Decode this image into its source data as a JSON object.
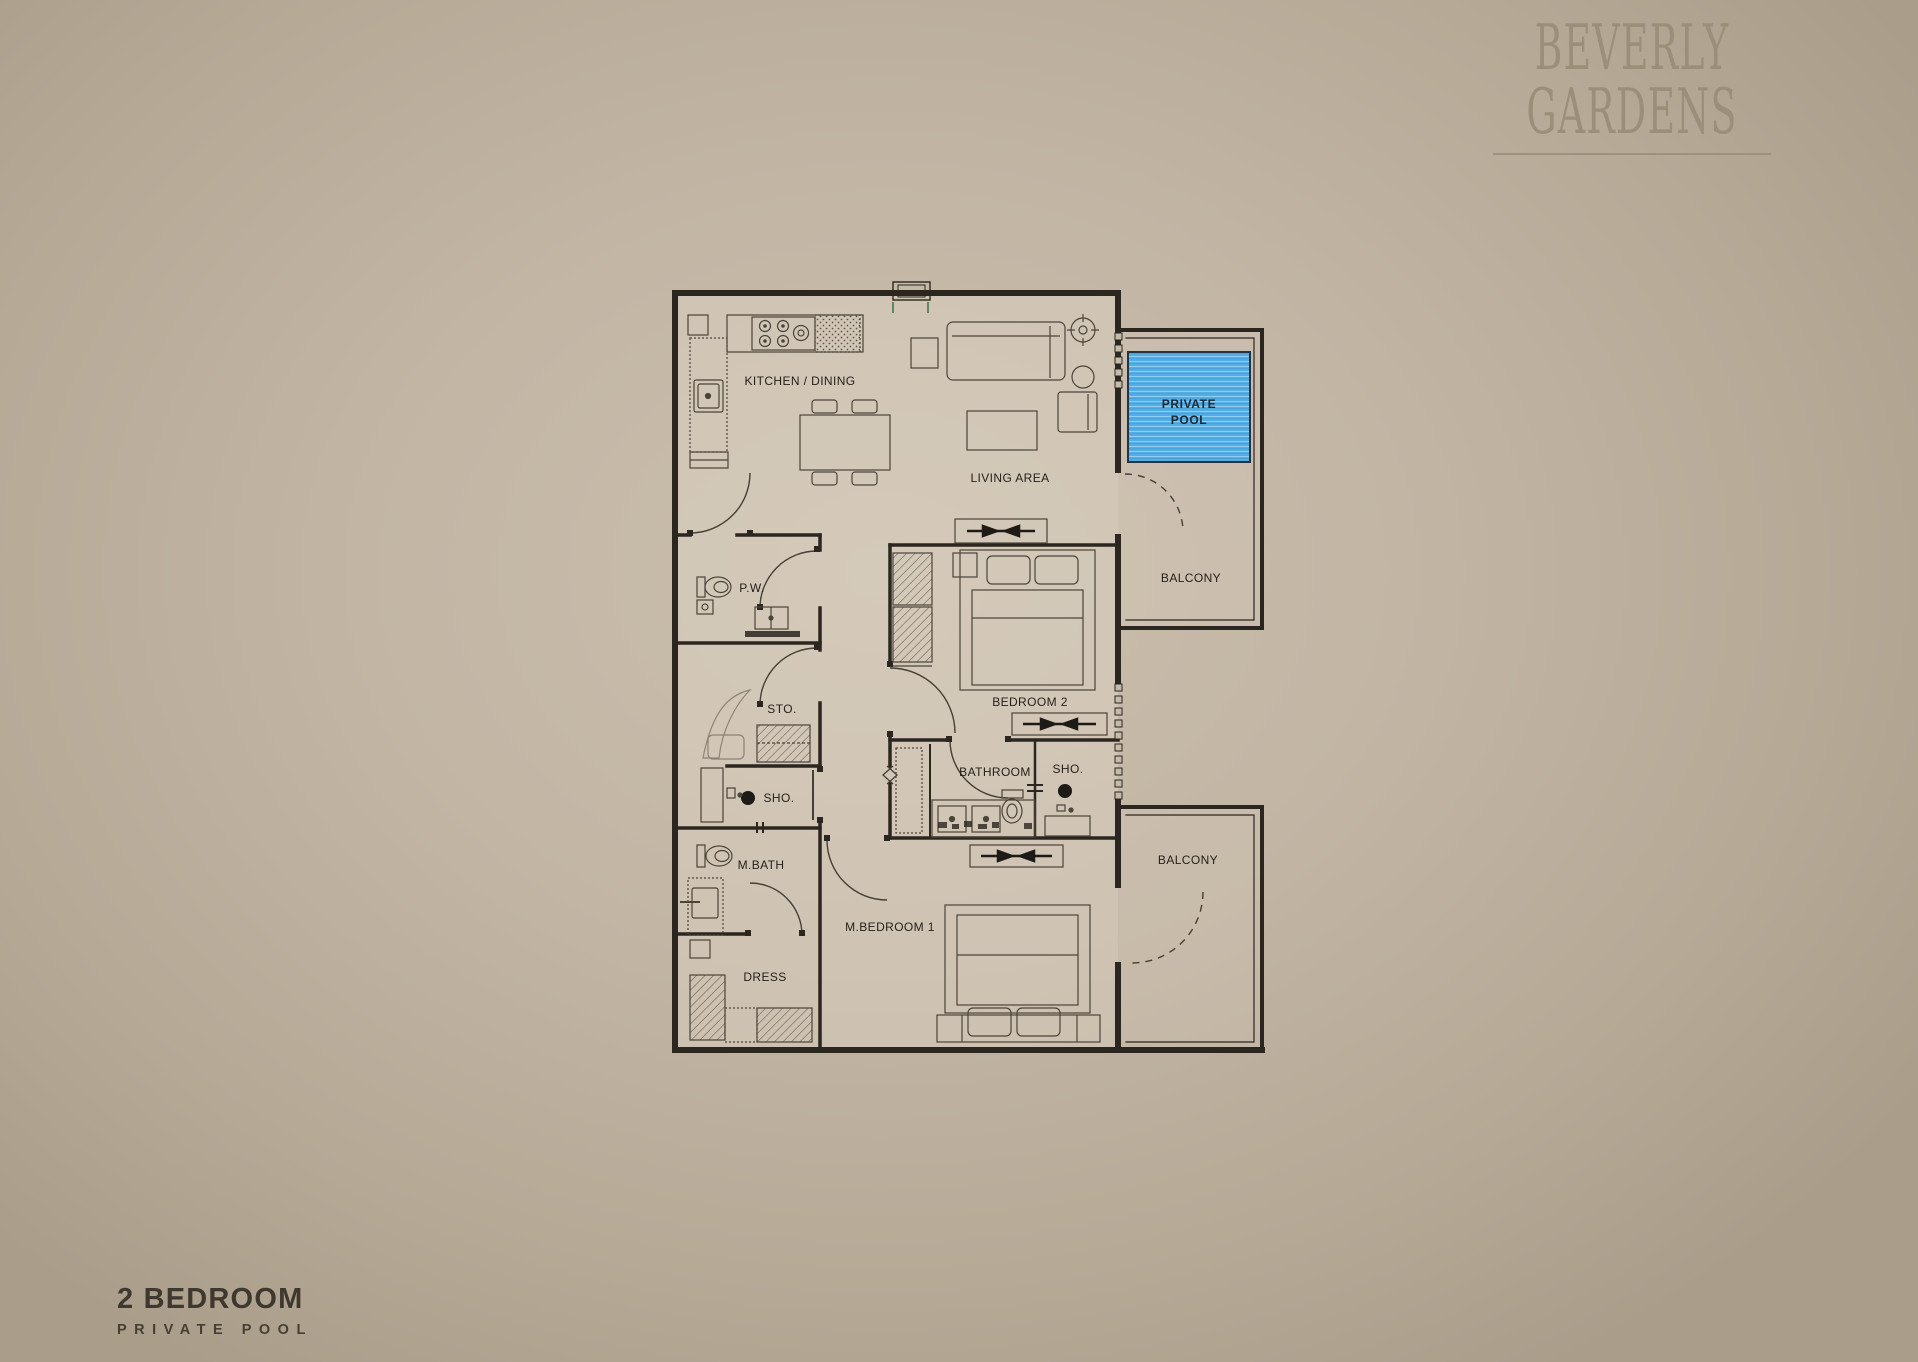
{
  "brand": {
    "name_line1": "BEVERLY",
    "name_line2": "GARDENS"
  },
  "unit": {
    "title": "2 BEDROOM",
    "subtitle": "PRIVATE POOL"
  },
  "plan": {
    "labels": {
      "kitchen_dining": "KITCHEN / DINING",
      "living_area": "LIVING AREA",
      "private_pool_line1": "PRIVATE",
      "private_pool_line2": "POOL",
      "balcony_upper": "BALCONY",
      "balcony_lower": "BALCONY",
      "powder_room": "P.W.",
      "storage": "STO.",
      "shower_left": "SHO.",
      "shower_right": "SHO.",
      "bedroom_2": "BEDROOM 2",
      "bathroom": "BATHROOM",
      "master_bath": "M.BATH",
      "master_bedroom": "M.BEDROOM 1",
      "dress": "DRESS"
    },
    "colors": {
      "pool_fill": "#55aee3",
      "pool_stripe": "#8fcdf1",
      "wall_line": "#2b2620",
      "furniture_line": "#4b4439",
      "background": "#c2b5a4",
      "brand_text": "#9c8f7a",
      "title_text": "#3e382e"
    }
  }
}
